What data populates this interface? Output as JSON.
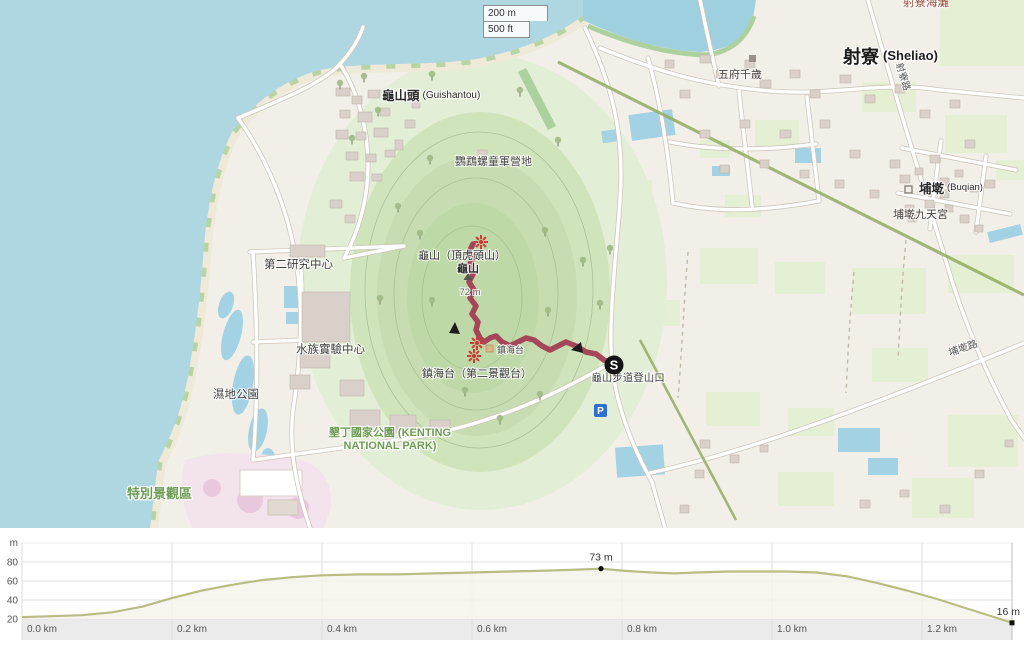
{
  "map": {
    "scalebar": {
      "metric": "200 m",
      "imperial": "500 ft"
    },
    "places": {
      "sheliao": "射寮",
      "sheliao_roman": "(Sheliao)",
      "guishantou": "龜山頭",
      "guishantou_roman": "(Guishantou)",
      "buqian": "埔墘",
      "buqian_roman": "(Buqian)"
    },
    "pois": {
      "wufu_temple": "五府千歲",
      "buqian_temple": "埔墘九天宮",
      "scout_camp": "鸚鵡螺童軍營地",
      "research_center": "第二研究中心",
      "aquarium_lab": "水族實驗中心",
      "wetland_park": "濕地公園",
      "guishan_peak_alt": "龜山（頂虎頭山）",
      "guishan": "龜山",
      "guishan_elev": "72 m",
      "zhenhai_small": "鎮海台",
      "zhenhai_platform": "鎮海台（第二景觀台）",
      "trailhead": "龜山步道登山口",
      "beach_clipped": "射寮海灘"
    },
    "areas": {
      "special_scenic": "特別景觀區",
      "kenting_line1": "墾丁國家公園 (KENTING",
      "kenting_line2": "NATIONAL PARK)"
    },
    "roads": {
      "sheliao_rd": "射寮路",
      "buqian_rd": "埔墘路"
    },
    "markers": {
      "start": "S",
      "parking": "P"
    },
    "colors": {
      "trail": "#a23a50",
      "water": "#aed7e2",
      "hill": "#cfe4bb",
      "park_label": "#6d9c55",
      "profile_line": "#b9bd83"
    }
  },
  "chart_data": {
    "type": "area",
    "title": "Elevation profile",
    "ylabel": "m",
    "yticks": [
      20,
      40,
      60,
      80
    ],
    "xticks": [
      {
        "km": 0.0,
        "label": "0.0 km"
      },
      {
        "km": 0.2,
        "label": "0.2 km"
      },
      {
        "km": 0.4,
        "label": "0.4 km"
      },
      {
        "km": 0.6,
        "label": "0.6 km"
      },
      {
        "km": 0.8,
        "label": "0.8 km"
      },
      {
        "km": 1.0,
        "label": "1.0 km"
      },
      {
        "km": 1.2,
        "label": "1.2 km"
      }
    ],
    "x_range_km": [
      0,
      1.32
    ],
    "grid": true,
    "profile": [
      [
        0.0,
        22
      ],
      [
        0.04,
        23
      ],
      [
        0.08,
        24
      ],
      [
        0.12,
        27
      ],
      [
        0.16,
        33
      ],
      [
        0.2,
        42
      ],
      [
        0.24,
        50
      ],
      [
        0.28,
        56
      ],
      [
        0.32,
        61
      ],
      [
        0.36,
        64
      ],
      [
        0.4,
        66
      ],
      [
        0.45,
        67
      ],
      [
        0.5,
        67
      ],
      [
        0.55,
        68
      ],
      [
        0.6,
        69
      ],
      [
        0.65,
        70
      ],
      [
        0.7,
        71
      ],
      [
        0.74,
        72
      ],
      [
        0.772,
        73
      ],
      [
        0.8,
        71
      ],
      [
        0.84,
        69
      ],
      [
        0.87,
        68
      ],
      [
        0.9,
        69
      ],
      [
        0.94,
        70
      ],
      [
        0.98,
        70
      ],
      [
        1.02,
        70
      ],
      [
        1.06,
        69
      ],
      [
        1.1,
        65
      ],
      [
        1.14,
        58
      ],
      [
        1.18,
        50
      ],
      [
        1.22,
        41
      ],
      [
        1.26,
        31
      ],
      [
        1.3,
        21
      ],
      [
        1.32,
        16
      ]
    ],
    "annotations": [
      {
        "km": 0.772,
        "m": 73,
        "label": "73 m",
        "marker": "dot",
        "align": "middle"
      },
      {
        "km": 1.32,
        "m": 16,
        "label": "16 m",
        "marker": "square",
        "align": "end"
      }
    ]
  }
}
